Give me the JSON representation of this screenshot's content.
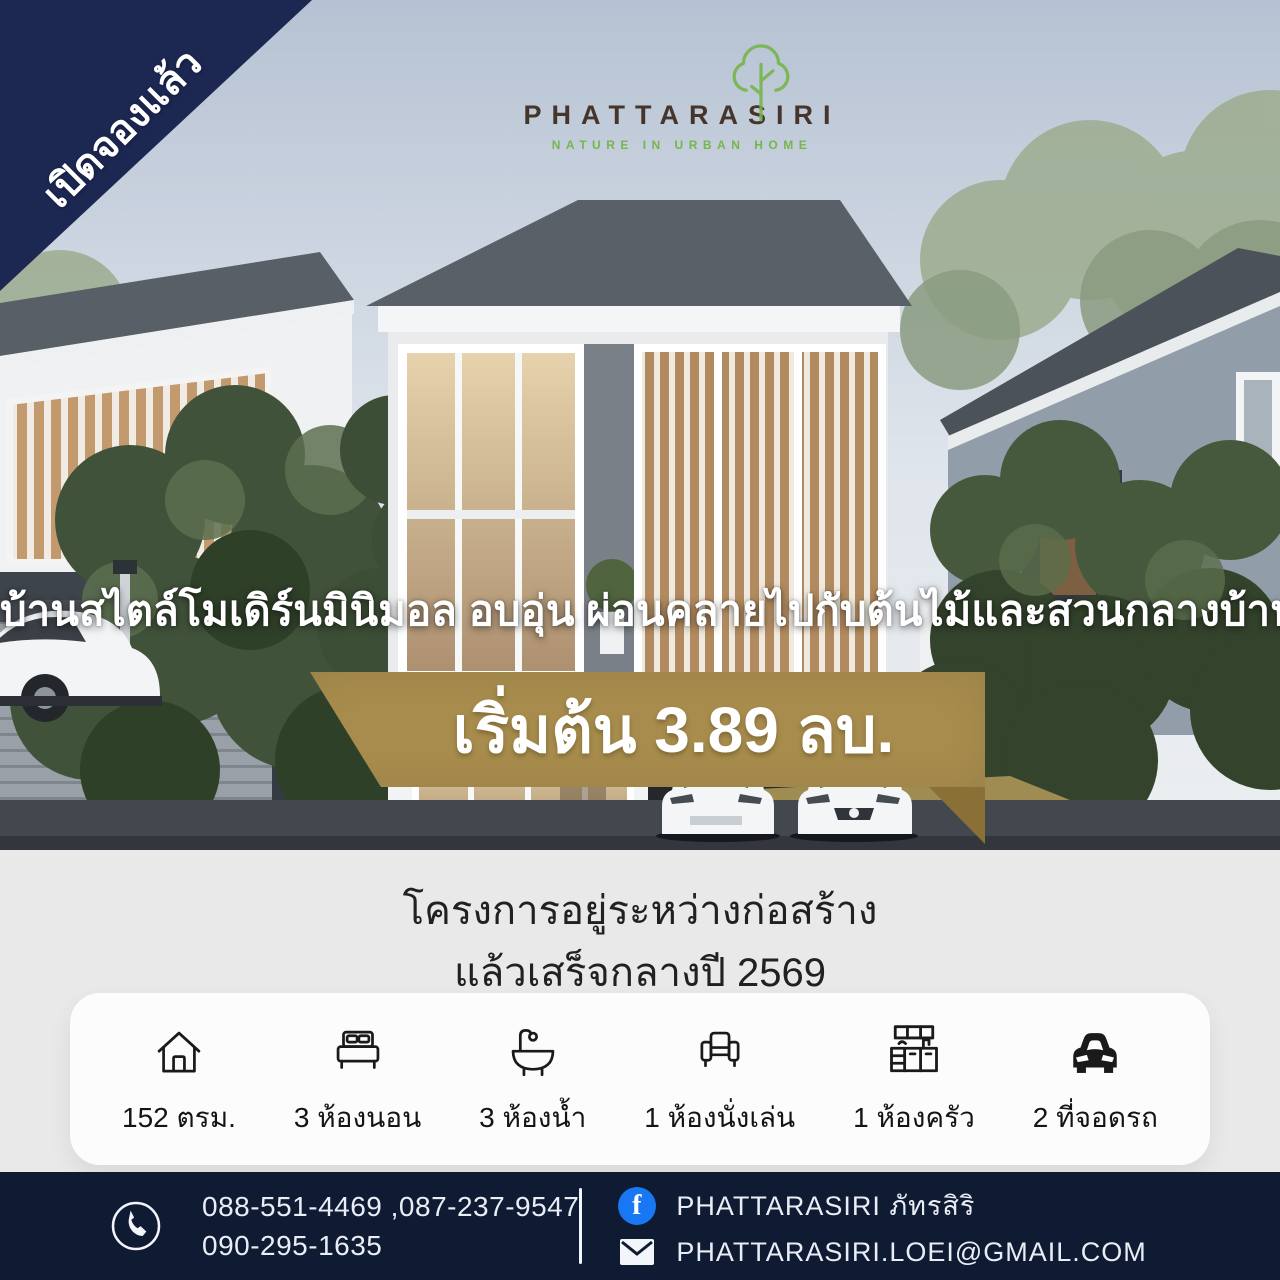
{
  "ribbon": {
    "label": "เปิดจองแล้ว"
  },
  "logo": {
    "name": "PHATTARASIRI",
    "tagline": "NATURE IN URBAN HOME",
    "icon": "tree-icon"
  },
  "hero": {
    "headline": "บ้านสไตล์โมเดิร์นมินิมอล อบอุ่น ผ่อนคลายไปกับต้นไม้และสวนกลางบ้าน",
    "price_banner": "เริ่มต้น 3.89 ลบ."
  },
  "status": {
    "line1": "โครงการอยู่ระหว่างก่อสร้าง",
    "line2": "แล้วเสร็จกลางปี 2569"
  },
  "features": [
    {
      "icon": "house-icon",
      "label": "152 ตรม."
    },
    {
      "icon": "bed-icon",
      "label": "3 ห้องนอน"
    },
    {
      "icon": "bathtub-icon",
      "label": "3 ห้องน้ำ"
    },
    {
      "icon": "sofa-icon",
      "label": "1 ห้องนั่งเล่น"
    },
    {
      "icon": "kitchen-icon",
      "label": "1 ห้องครัว"
    },
    {
      "icon": "car-icon",
      "label": "2 ที่จอดรถ"
    }
  ],
  "footer": {
    "phones_line1": "088-551-4469 ,087-237-9547",
    "phones_line2": "090-295-1635",
    "facebook": "PHATTARASIRI ภัทรสิริ",
    "email": "PHATTARASIRI.LOEI@GMAIL.COM",
    "facebook_glyph": "f"
  },
  "colors": {
    "navy": "#1c2752",
    "footer-navy": "#0f1b32",
    "gold": "#a78c4d",
    "gold-dark": "#8a7036",
    "logo-green": "#76b64a",
    "logo-brown": "#46352a",
    "facebook-blue": "#1877f2"
  }
}
